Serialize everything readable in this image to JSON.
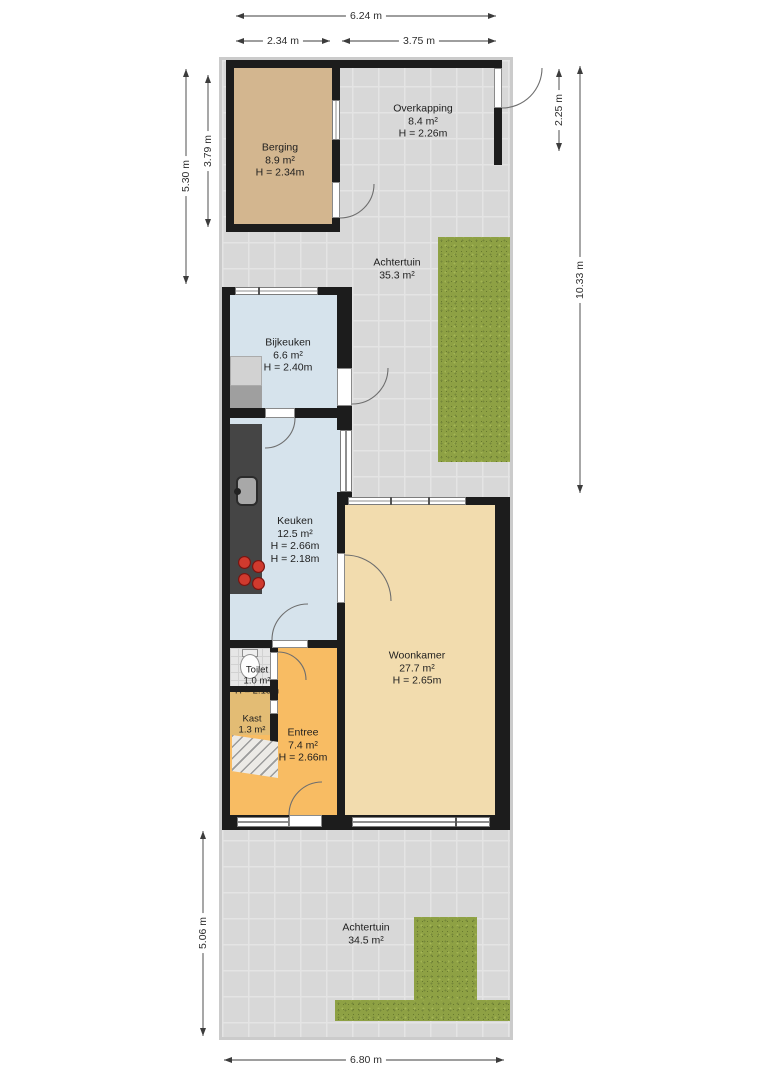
{
  "rooms": {
    "berging": {
      "name": "Berging",
      "area": "8.9 m²",
      "height": "H = 2.34m"
    },
    "overkapping": {
      "name": "Overkapping",
      "area": "8.4 m²",
      "height": "H = 2.26m"
    },
    "achtertuin_boven": {
      "name": "Achtertuin",
      "area": "35.3 m²"
    },
    "bijkeuken": {
      "name": "Bijkeuken",
      "area": "6.6 m²",
      "height": "H = 2.40m"
    },
    "keuken": {
      "name": "Keuken",
      "area": "12.5 m²",
      "height": "H = 2.66m",
      "height2": "H = 2.18m"
    },
    "woonkamer": {
      "name": "Woonkamer",
      "area": "27.7 m²",
      "height": "H = 2.65m"
    },
    "toilet": {
      "name": "Toilet",
      "area": "1.0 m²",
      "height": "H = 2.15m"
    },
    "kast": {
      "name": "Kast",
      "area": "1.3 m²"
    },
    "entree": {
      "name": "Entree",
      "area": "7.4 m²",
      "height": "H = 2.66m"
    },
    "achtertuin_onder": {
      "name": "Achtertuin",
      "area": "34.5 m²"
    }
  },
  "dimensions": {
    "top_total": "6.24 m",
    "top_left": "2.34 m",
    "top_right": "3.75 m",
    "left_outer": "5.30 m",
    "left_inner": "3.79 m",
    "right_top": "2.25 m",
    "right_total": "10.33 m",
    "bottom_left": "5.06 m",
    "bottom_total": "6.80 m"
  },
  "colors": {
    "wall": "#1c1c1c",
    "paving": "#d8d8d8",
    "paving-line": "#e4e4e4",
    "grass": "#8ea144",
    "berging": "#d3b68f",
    "kitchen": "#d6e3ec",
    "woonkamer": "#f2dcae",
    "entree": "#f8bc63",
    "kast": "#e3bc74"
  }
}
